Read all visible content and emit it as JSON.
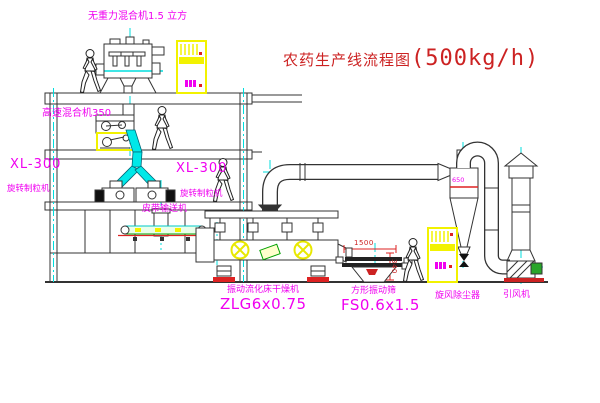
{
  "title": {
    "main": "农药生产线流程图",
    "capacity": "(500kg/h)"
  },
  "equipment": {
    "gravity_mixer": {
      "label": "无重力混合机1.5 立方"
    },
    "high_speed_mixer": {
      "label": "高速混合机350"
    },
    "granulator_left": {
      "model": "XL-300",
      "name": "旋转制粒机"
    },
    "granulator_right": {
      "model": "XL-300",
      "name": "旋转制粒机"
    },
    "belt_conveyor": {
      "name": "皮带输送机"
    },
    "fluid_bed_dryer": {
      "name": "振动流化床干燥机",
      "model": "ZLG6x0.75"
    },
    "vibrating_sieve": {
      "name": "方形振动筛",
      "model": "FS0.6x1.5"
    },
    "cyclone": {
      "name": "旋风除尘器",
      "dim": "650"
    },
    "induced_draft_fan": {
      "name": "引风机"
    }
  },
  "dimensions": {
    "sieve_width": "1500",
    "sieve_height": "340"
  },
  "colors": {
    "label_magenta": "#f000f0",
    "title_red": "#cc2222",
    "centerline_cyan": "#00dede",
    "cabinet_yellow": "#f2f200",
    "base_red": "#cc2222",
    "motor_green": "#2aa52a",
    "line_dark": "#333333"
  }
}
